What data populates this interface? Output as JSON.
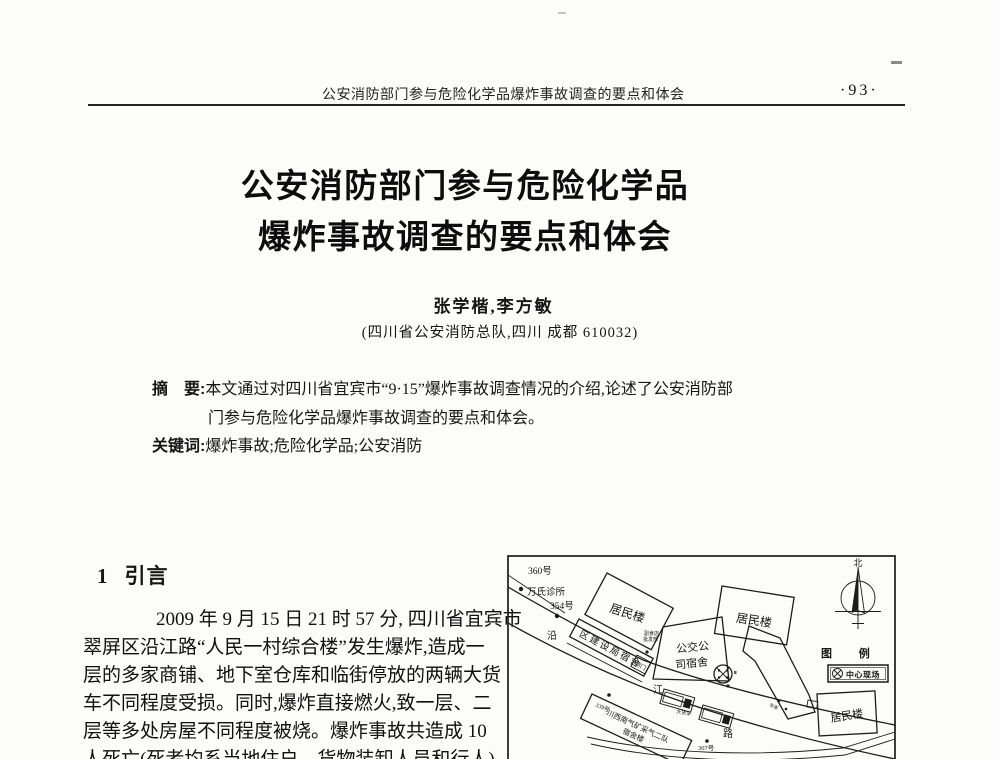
{
  "header": {
    "running_title": "公安消防部门参与危险化学品爆炸事故调查的要点和体会",
    "page_number": "·93·"
  },
  "title": {
    "line1": "公安消防部门参与危险化学品",
    "line2": "爆炸事故调查的要点和体会"
  },
  "byline": {
    "authors": "张学楷,李方敏",
    "affiliation": "(四川省公安消防总队,四川 成都 610032)"
  },
  "abstract": {
    "label": "摘　要:",
    "text_line1": "本文通过对四川省宜宾市“9·15”爆炸事故调查情况的介绍,论述了公安消防部",
    "text_line2": "门参与危险化学品爆炸事故调查的要点和体会。",
    "keywords_label": "关键词:",
    "keywords": "爆炸事故;危险化学品;公安消防"
  },
  "intro": {
    "number": "1",
    "title": "引言",
    "lines": [
      "2009 年 9 月 15 日 21 时 57 分, 四川省宜宾市",
      "翠屏区沿江路“人民一村综合楼”发生爆炸,造成一",
      "层的多家商铺、地下室仓库和临街停放的两辆大货",
      "车不同程度受损。同时,爆炸直接燃火,致一层、二",
      "层等多处房屋不同程度被烧。爆炸事故共造成 10",
      "人死亡(死者均系当地住户、货物装卸人员和行人)"
    ]
  },
  "map": {
    "poi_360": "360号",
    "poi_wanshi": "万氏诊所",
    "poi_354": "354号",
    "poi_339": "339号",
    "poi_307": "307号",
    "building_residential": "居民楼",
    "building_construction": "区建设局宿舍",
    "building_bus_1": "公交公",
    "building_bus_2": "司宿舍",
    "building_gas_1": "川西南气矿采气二队",
    "building_gas_2": "宿舍楼",
    "side_door": "侧门",
    "truck_label": "大货车",
    "shop_label_1": "副食店",
    "shop_label_2": "批发部",
    "garage_label": "车库",
    "road_char_1": "沿",
    "road_char_2": "江",
    "road_char_3": "路",
    "compass_north": "北",
    "legend_title": "图 例",
    "legend_center_scene": "中心现场"
  }
}
